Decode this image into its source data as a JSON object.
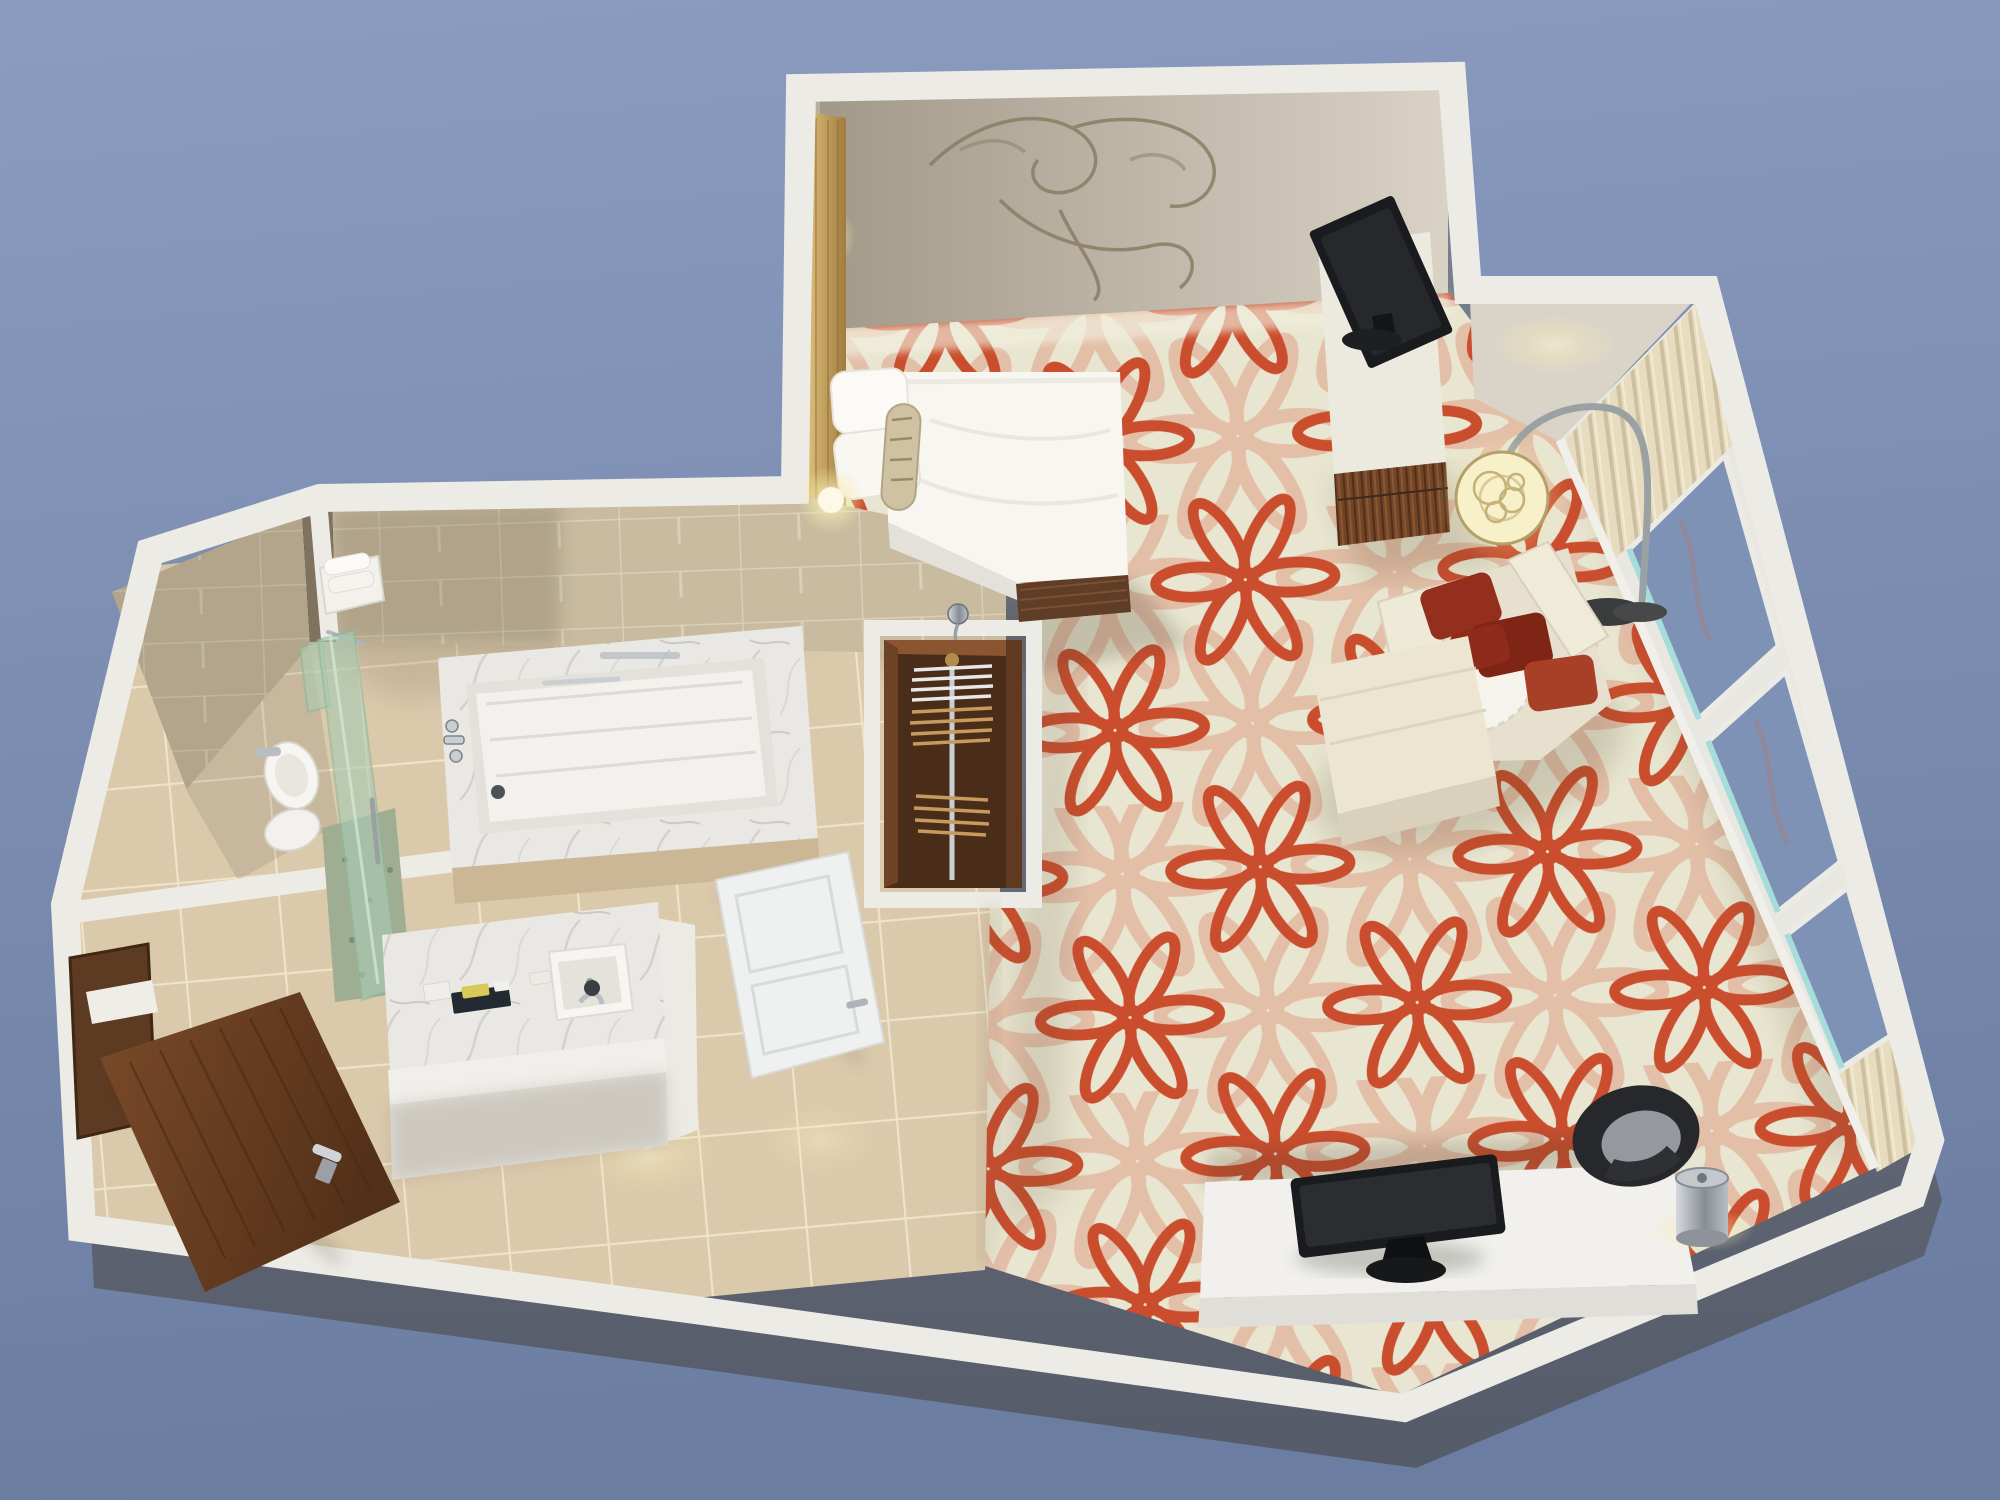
{
  "scene": {
    "kind": "isometric-3d-render",
    "subject": "hotel-guest-room-cutaway-floor-plan",
    "rooms": [
      {
        "name": "bedroom",
        "items": [
          "king bed",
          "white pillows",
          "patterned bolster pillow",
          "gold headboard panel",
          "wall sconces",
          "swirl wall artwork",
          "tv console",
          "flat screen tv",
          "cream lounge chair",
          "red throw pillows",
          "white seat throw",
          "ottoman",
          "arc floor lamp with circle shade",
          "alcove downlight",
          "window wall",
          "sheer blue glazing",
          "curtain panels",
          "work desk",
          "desktop monitor",
          "black tub chair",
          "ice bucket"
        ]
      },
      {
        "name": "bathroom",
        "items": [
          "bathtub",
          "marble tub deck",
          "chrome tub faucets",
          "grab bar",
          "hand shower",
          "green glass shower partition",
          "speckled shower floor",
          "toilet",
          "towel shelf with towels",
          "vanity with marble top",
          "undermount sink",
          "chrome faucet",
          "amenity tray",
          "tiled walls",
          "tiled floor"
        ]
      },
      {
        "name": "closet",
        "items": [
          "dark wood wardrobe",
          "chrome hanging rod",
          "white hangers",
          "wood hangers",
          "luggage shelf"
        ]
      },
      {
        "name": "entry",
        "items": [
          "walnut entry door",
          "walnut side door",
          "white bathroom door",
          "tile floor",
          "ceiling light pools"
        ]
      }
    ]
  },
  "palette": {
    "bg_top": "#8b9cc0",
    "bg_bottom": "#6b7da1",
    "slab_top": "#7a8190",
    "slab_bottom": "#555b69",
    "wall_cap": "#edebe5",
    "wall_face_light": "#d9d2c5",
    "wall_face_shadow": "#a29888",
    "alcove_face": "#dad4c8",
    "tile_wall": "#c8bb9f",
    "tile_wall_grout": "#dacfb8",
    "tile_floor": "#dbc9ac",
    "tile_floor_grout": "#efe3cb",
    "carpet_base": "#e8e5d0",
    "carpet_coral": "#ca4e2e",
    "carpet_faded": "#dd9a80",
    "headboard_gold_light": "#dcbd78",
    "headboard_gold_dark": "#a07c3e",
    "wood_door_light": "#7a4a28",
    "wood_door_dark": "#53301a",
    "console_wood": "#734526",
    "closet_wood": "#4a2d18",
    "bed_white": "#f7f6f1",
    "fabric_cream": "#e7e0ce",
    "fabric_cream_light": "#f0ead9",
    "pillow_red_dark": "#7e2515",
    "pillow_red_mid": "#952f1d",
    "pillow_red_bright": "#a84027",
    "marble_base": "#eae8e4",
    "fixture_white": "#f2f1ed",
    "glass_green": "#a9cbb2",
    "shower_floor": "#9fae93",
    "window_glass": "#7e92b6",
    "window_glass_edge": "#9fdbd9",
    "curtain_light": "#e7dcc0",
    "curtain_dark": "#cdbf9f",
    "lamp_glow": "#f7f0c8",
    "lamp_trim": "#b3a06a",
    "tv_black": "#1a1b1e",
    "chrome": "#c9ced2",
    "desk_top": "#f1f0ec",
    "chair_black": "#26282b",
    "chair_seat": "#95999f",
    "artwork_line": "#8a7d63"
  }
}
